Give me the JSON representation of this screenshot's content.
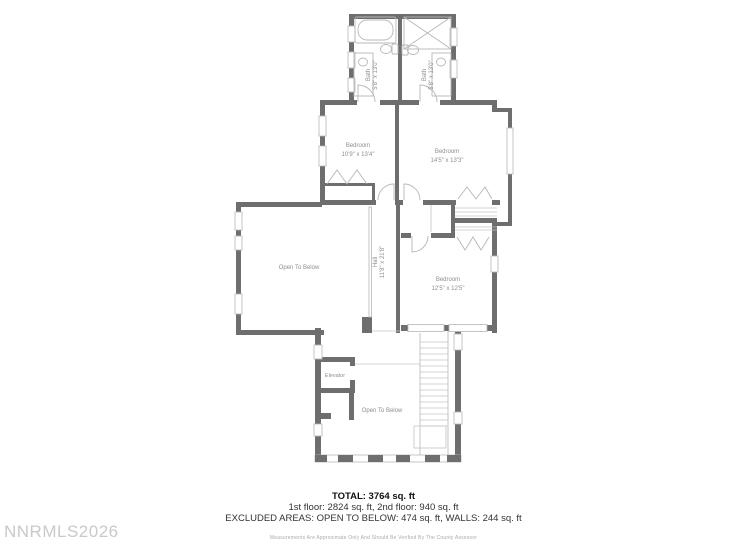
{
  "watermark": "NNRMLS2026",
  "rooms": {
    "bath_left": {
      "name": "Bath",
      "dims": "5'8\" x 13'0\""
    },
    "bath_right": {
      "name": "Bath",
      "dims": "5'8\" x 13'0\""
    },
    "bedroom_left": {
      "name": "Bedroom",
      "dims": "10'9\" x 13'4\""
    },
    "bedroom_right": {
      "name": "Bedroom",
      "dims": "14'5\" x 13'3\""
    },
    "bedroom_lower": {
      "name": "Bedroom",
      "dims": "12'5\" x 12'5\""
    },
    "hall": {
      "name": "Hall",
      "dims": "11'8\" x 21'8\""
    },
    "open_to_below_upper": {
      "name": "Open To Below"
    },
    "open_to_below_lower": {
      "name": "Open To Below"
    },
    "elevator": {
      "name": "Elevator"
    }
  },
  "summary": {
    "total": "TOTAL: 3764 sq. ft",
    "floors": "1st floor: 2824 sq. ft, 2nd floor: 940 sq. ft",
    "excluded": "EXCLUDED AREAS: OPEN TO BELOW: 474 sq. ft, WALLS: 244 sq. ft",
    "disclaimer": "Measurements Are Approximate Only And Should Be Verified By The County Assessor"
  },
  "colors": {
    "wall": "#6e6e6e",
    "fixture": "#b7b7b7",
    "room_label": "#8e8e8e",
    "summary_text": "#333333",
    "watermark": "#c9c9c9",
    "background": "#ffffff"
  }
}
